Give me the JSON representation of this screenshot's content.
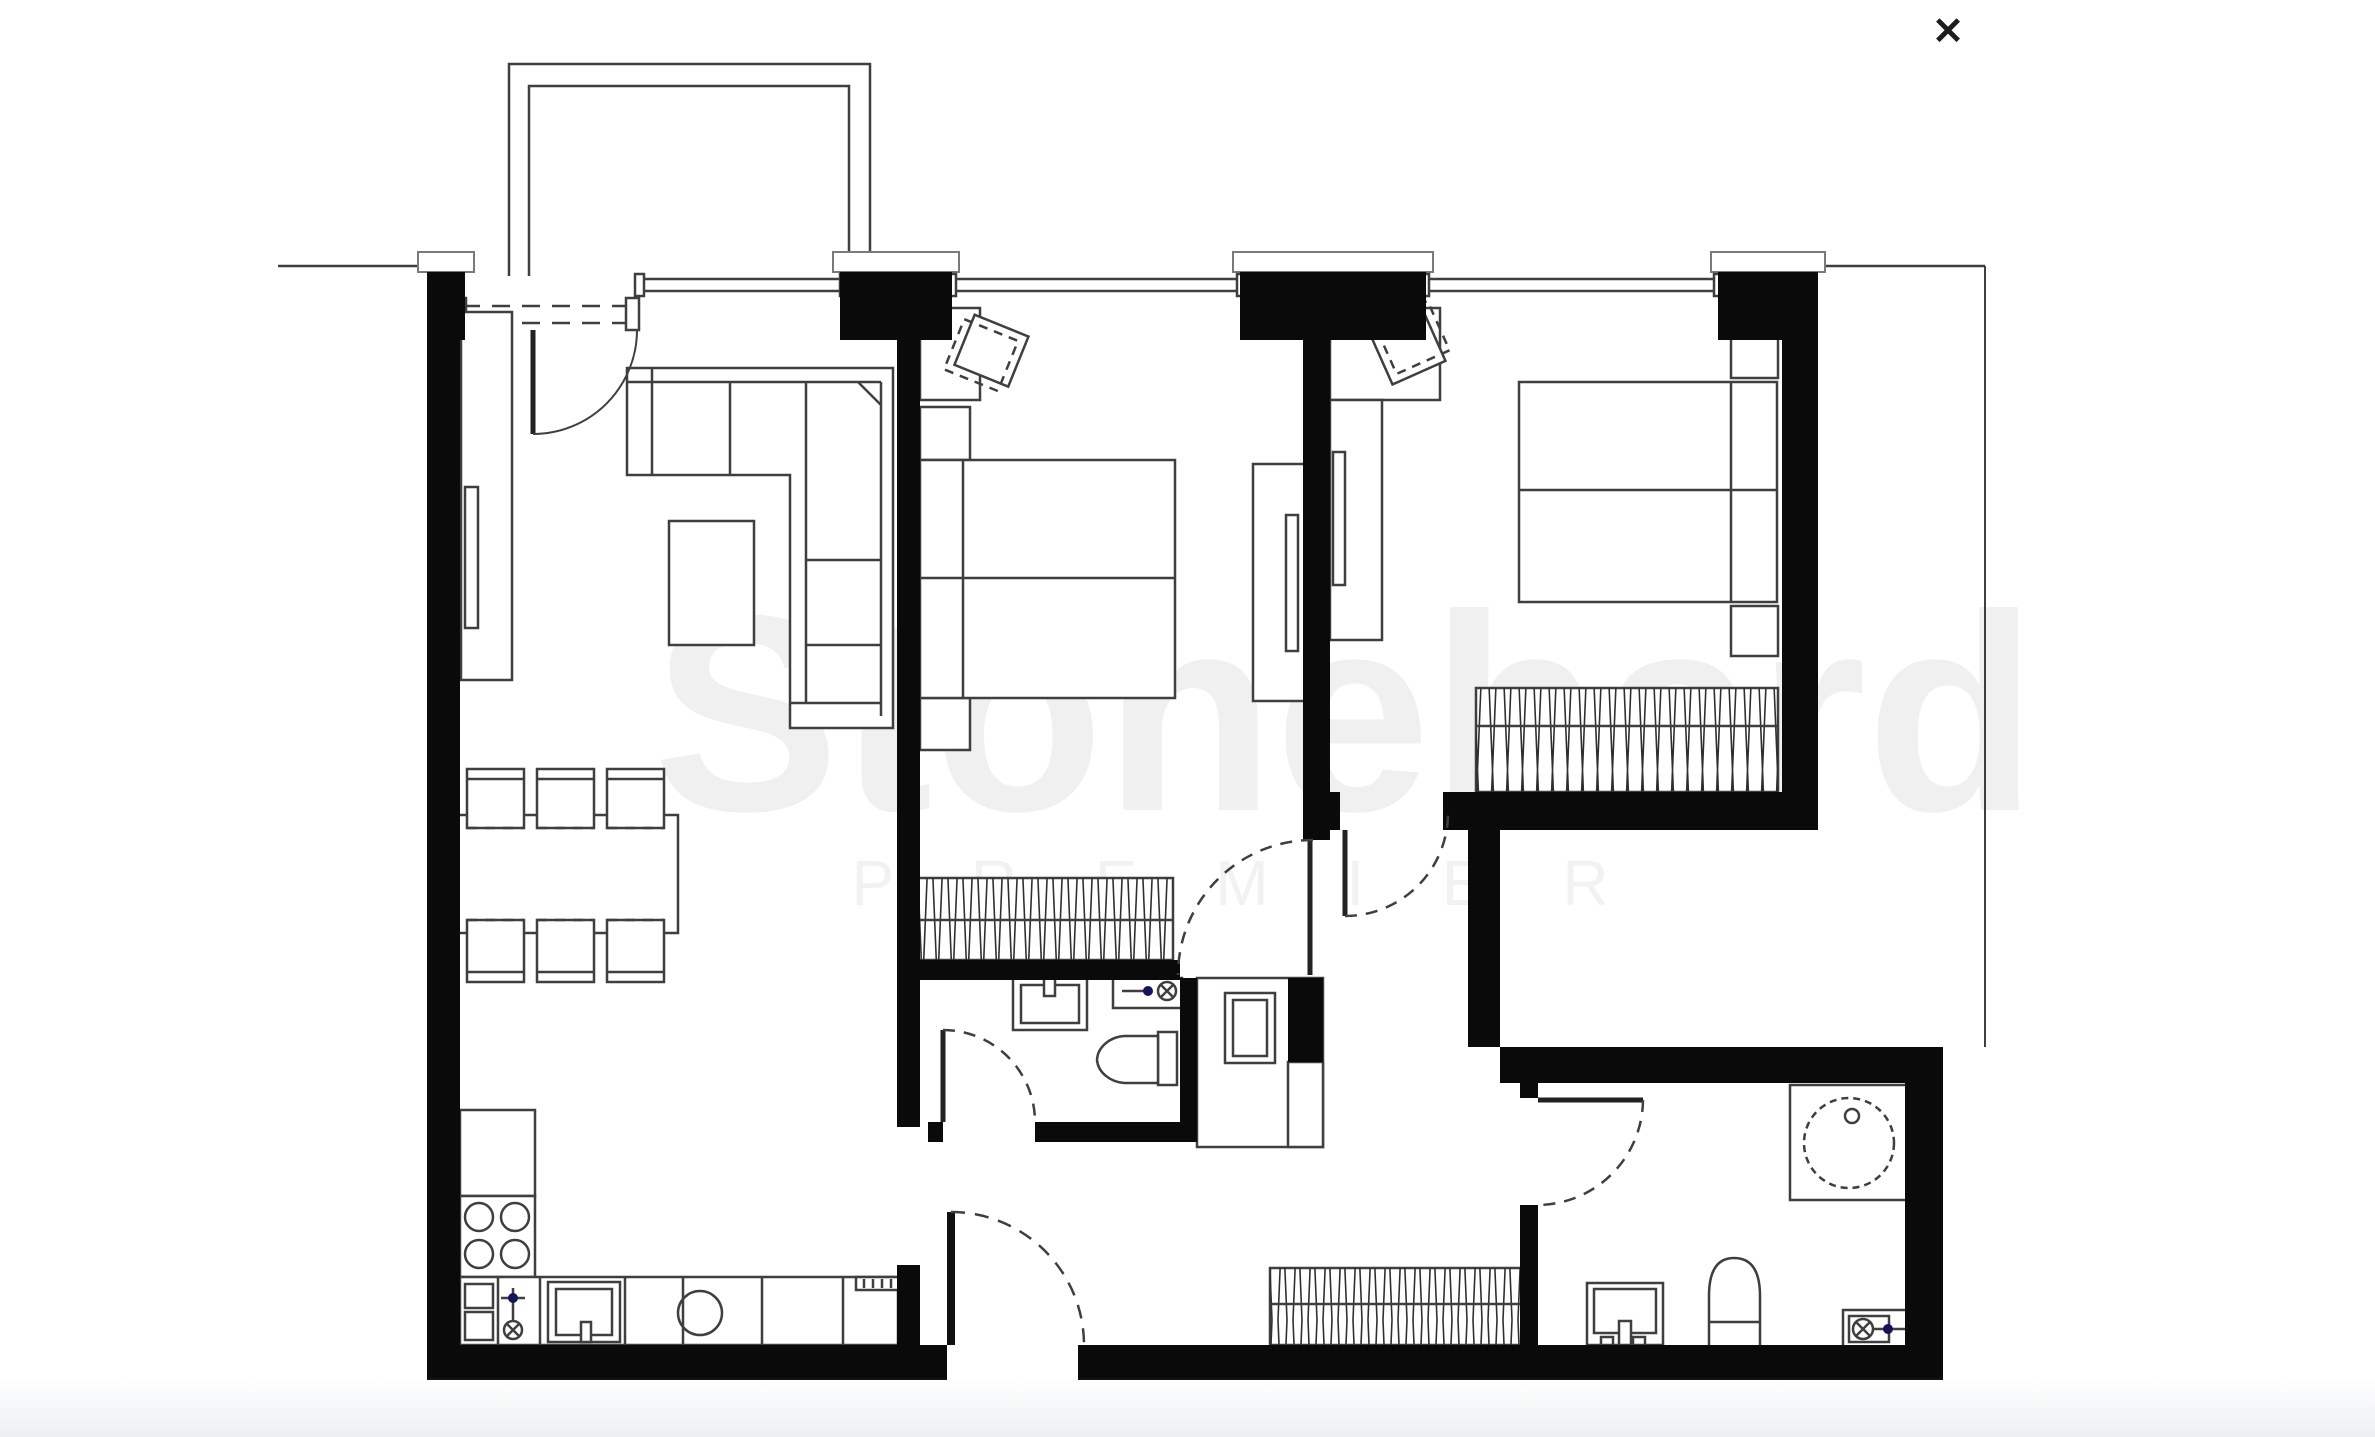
{
  "viewer": {
    "type": "floor-plan-lightbox",
    "close_label": "✕"
  },
  "watermark": {
    "line1": "Stonehard",
    "line2": "P R E M I E R",
    "line1_color": "#f0f0f0",
    "line2_color": "#f2f2f2"
  },
  "colors": {
    "background": "#ffffff",
    "walls": "#0a0a0a",
    "drawing_lines": "#3f3f3f",
    "light_lines": "#8a8a8a",
    "valve_accent": "#14145a",
    "bottom_fade": "#edeff2"
  },
  "floor_plan": {
    "style": "black-and-white architectural plan",
    "symbols": [
      "balcony-railing",
      "entry-door-arc",
      "window-band",
      "corner-sofa-icon",
      "coffee-table-icon",
      "tv-stand-icon",
      "dining-table-icon",
      "dining-chair-icon",
      "stove-burners-icon",
      "kitchen-counter-icon",
      "kitchen-sink-icon",
      "fridge-icon",
      "gas-valve-icon",
      "double-bed-icon",
      "nightstand-icon",
      "desk-icon",
      "desk-chair-icon",
      "sliding-wardrobe-icon",
      "hatched-wardrobe-icon",
      "washing-machine-icon",
      "duct-shaft-icon",
      "washbasin-icon",
      "toilet-icon",
      "round-tub-icon",
      "water-valve-icon",
      "door-swing-arc"
    ],
    "rooms_count": 7,
    "doors_count": 7,
    "windows_count": 3
  }
}
